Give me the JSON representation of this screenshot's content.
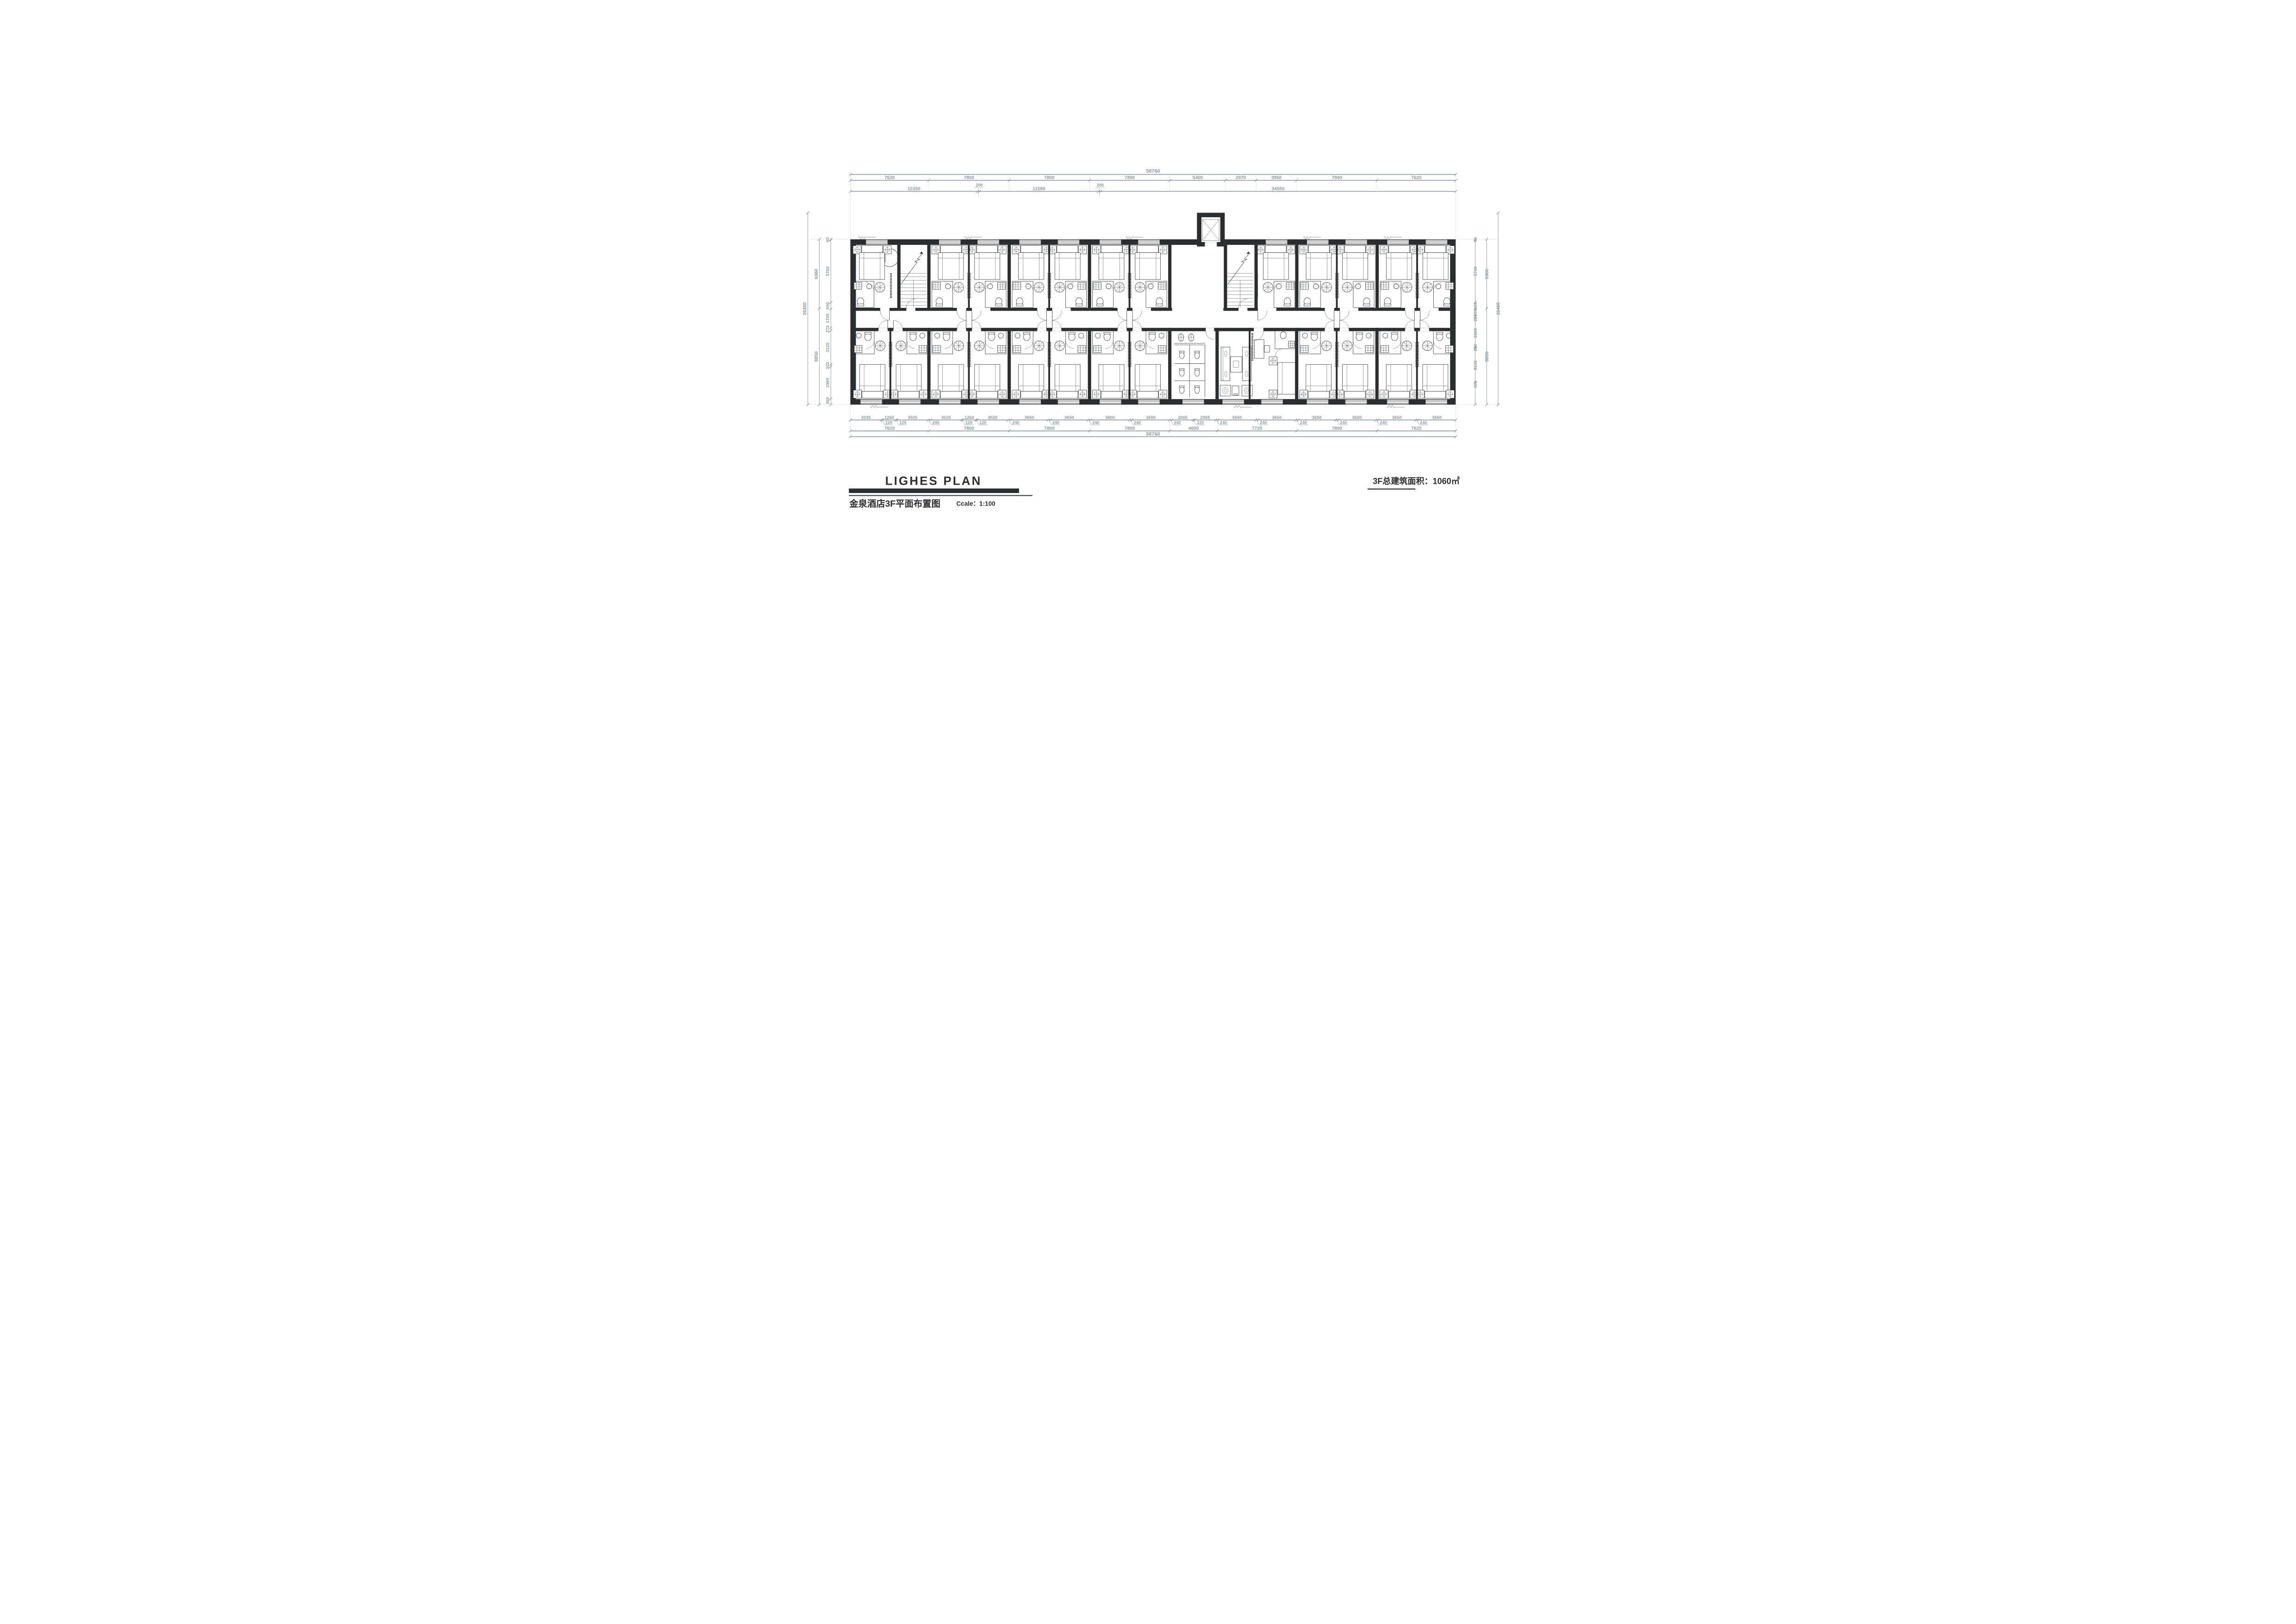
{
  "sheet": {
    "title": "LIGHES PLAN",
    "subtitle": "金泉酒店3F平面布置图",
    "scale_label": "Ccale：1:100",
    "area_note": "3F总建筑面积：1060㎡"
  },
  "colors": {
    "ink": "#2b2e30",
    "dimension": "#8c9ba3",
    "extension": "#c3ced2",
    "paper": "#ffffff"
  },
  "dimensions": {
    "top": {
      "overall": "58760",
      "row1": [
        "7620",
        "7800",
        "7800",
        "7800",
        "5400",
        "2970",
        "3950",
        "7800",
        "7620"
      ],
      "row2": [
        "12350",
        "200",
        "11580",
        "200",
        "34550"
      ]
    },
    "bottom": {
      "segments": [
        "3030",
        "1260",
        "3025",
        "3020",
        "1260",
        "3020",
        "3650",
        "3650",
        "3800",
        "3650",
        "2065",
        "2065",
        "3650",
        "3650",
        "3650",
        "3650",
        "3650",
        "3650"
      ],
      "gaps": [
        "120",
        "125",
        "240",
        "120",
        "120",
        "240",
        "240",
        "240",
        "240",
        "240",
        "120",
        "240",
        "240",
        "240",
        "240",
        "240",
        "240"
      ],
      "row2": [
        "7620",
        "7800",
        "7800",
        "7800",
        "4600",
        "7720",
        "7800",
        "7620"
      ],
      "overall": "58760"
    },
    "left": {
      "outer": "26400",
      "mid": [
        "6360",
        "8850"
      ],
      "inner": [
        "60",
        "5760",
        "600",
        "1700",
        "270",
        "3120",
        "200",
        "2960",
        "360"
      ]
    },
    "right": {
      "outer": "26400",
      "mid": [
        "6360",
        "8850"
      ],
      "inner": [
        "60",
        "5760",
        "600",
        "700",
        "200",
        "2600",
        "100",
        "3150",
        "360"
      ]
    }
  }
}
